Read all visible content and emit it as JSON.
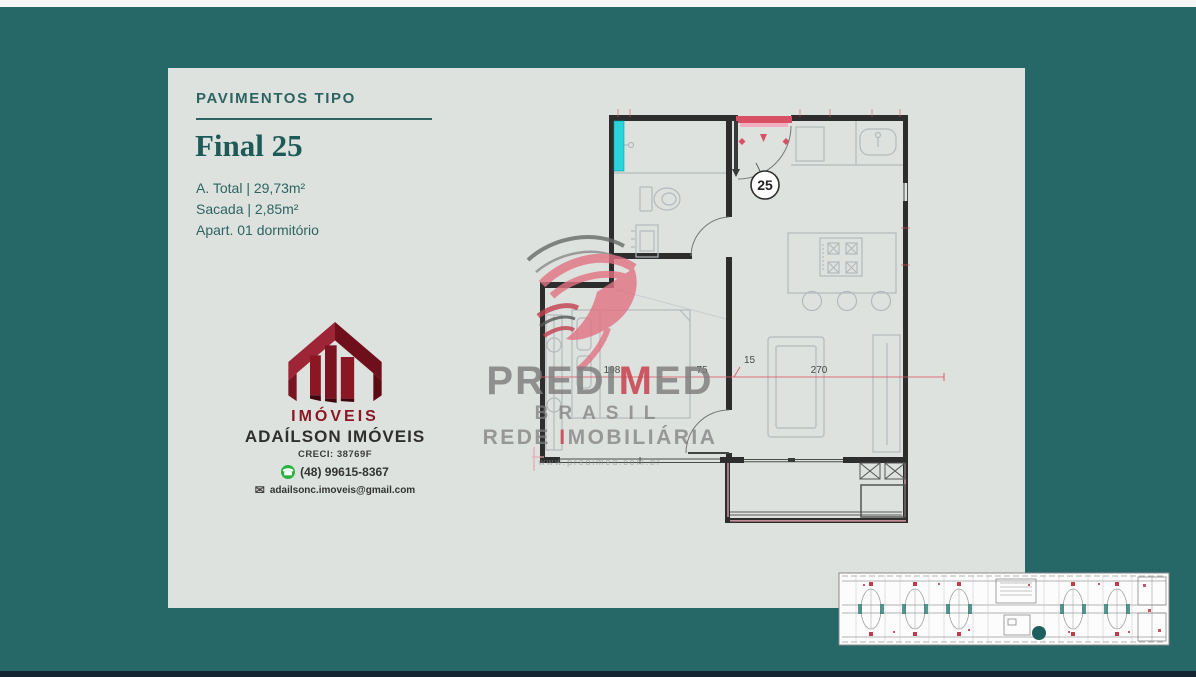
{
  "header": {
    "category": "PAVIMENTOS TIPO",
    "unit_title": "Final 25"
  },
  "details": {
    "area_total": "A. Total | 29,73m²",
    "balcony": "Sacada | 2,85m²",
    "apartment": "Apart. 01 dormitório"
  },
  "agency": {
    "logo_caption": "IMÓVEIS",
    "name": "ADAÍLSON IMÓVEIS",
    "creci": "CRECI: 38769F",
    "phone": "(48) 99615-8367",
    "email": "adailsonc.imoveis@gmail.com"
  },
  "watermark": {
    "brand_pre": "PREDI",
    "brand_accent": "M",
    "brand_post": "ED",
    "country": "BRASIL",
    "network_pre": "REDE ",
    "network_accent": "I",
    "network_post": "MOBILIÁRIA",
    "url": "www.predimed.com.br"
  },
  "floorplan": {
    "unit_number": "25",
    "dims": {
      "bedroom_width": "198",
      "hall": "75",
      "wall": "15",
      "living_width": "270"
    }
  },
  "colors": {
    "background_teal": "#266868",
    "panel": "#dde2de",
    "heading_teal": "#2d6462",
    "brand_maroon": "#8c1724",
    "accent_red": "#d94f63",
    "watermark_red": "#c8414e",
    "shower_cyan": "#2bd3da",
    "whatsapp_green": "#27b43e",
    "unit_marker_teal": "#1d5f5f"
  }
}
